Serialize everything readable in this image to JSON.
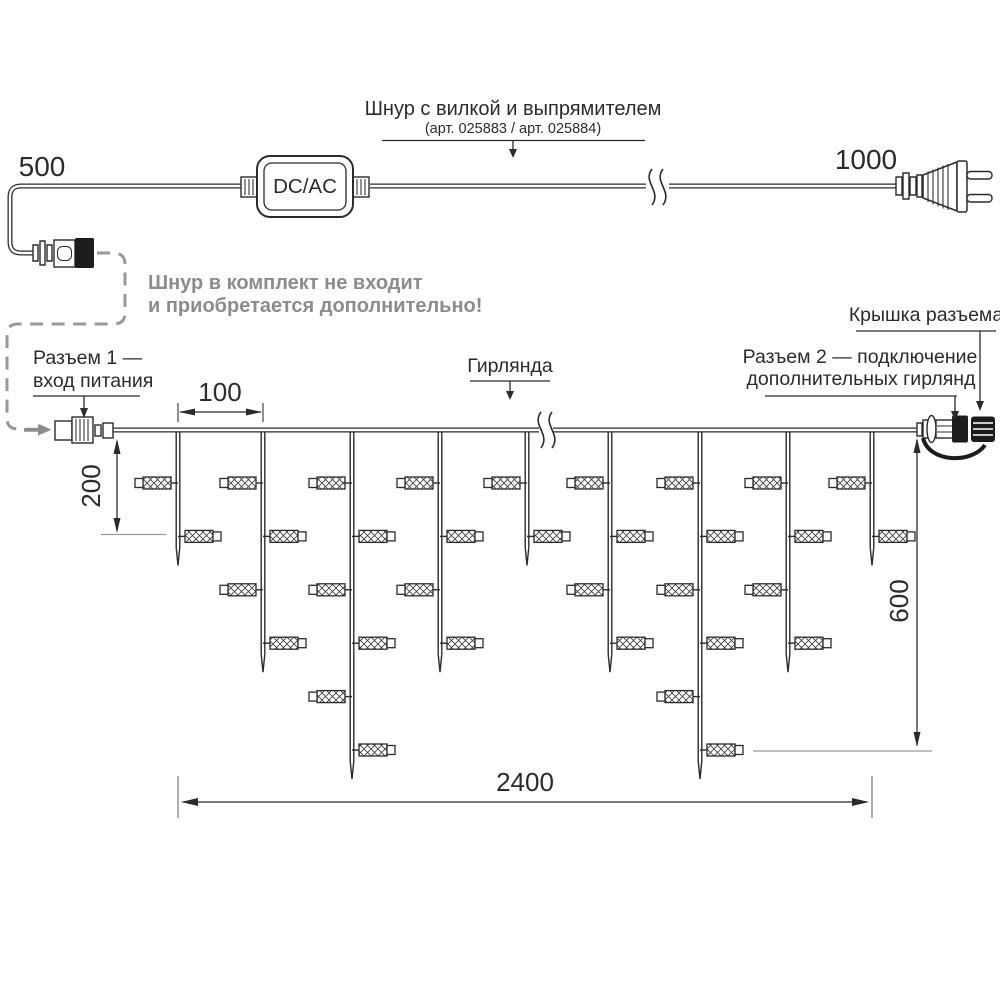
{
  "power_cord": {
    "length_left_mm": "500",
    "length_right_mm": "1000",
    "converter_label": "DC/AC",
    "cord_title": "Шнур с вилкой и выпрямителем",
    "cord_subtitle": "(арт. 025883 / арт. 025884)",
    "note_line1": "Шнур в комплект не входит",
    "note_line2": "и приобретается дополнительно!"
  },
  "garland": {
    "connector1_label_line1": "Разъем 1 —",
    "connector1_label_line2": "вход питания",
    "garland_label": "Гирлянда",
    "cap_label": "Крышка разъема",
    "connector2_label_line1": "Разъем 2 — подключение",
    "connector2_label_line2": "дополнительных гирлянд",
    "structure": {
      "drop_top_y": 431.5,
      "first_row_y": 483,
      "row_spacing": 53.4,
      "drop_half_gap": 1.8,
      "tip_len": 18,
      "straight_after_last_lamp": 11,
      "drops": [
        {
          "x": 178,
          "lamps": 2
        },
        {
          "x": 263,
          "lamps": 4
        },
        {
          "x": 352,
          "lamps": 6
        },
        {
          "x": 440,
          "lamps": 4
        },
        {
          "x": 527,
          "lamps": 2
        },
        {
          "x": 610,
          "lamps": 4
        },
        {
          "x": 700,
          "lamps": 6
        },
        {
          "x": 788,
          "lamps": 4
        },
        {
          "x": 872,
          "lamps": 2
        }
      ]
    }
  },
  "dimensions": {
    "drop_spacing": "100",
    "first_drop_length": "200",
    "max_drop_length": "600",
    "total_length": "2400"
  },
  "colors": {
    "ink": "#2b2b2b",
    "gray": "#8c8c8c",
    "black_parts": "#1c1c1c"
  }
}
